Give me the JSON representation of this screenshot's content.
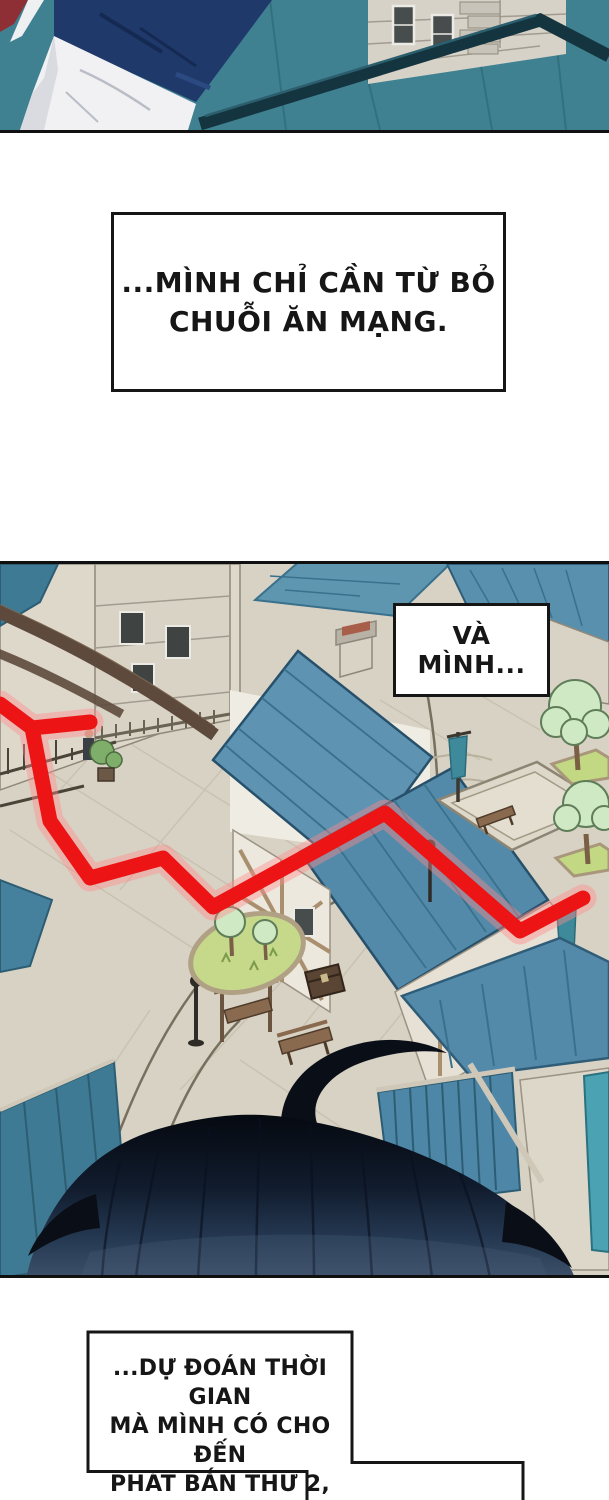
{
  "page": {
    "kind": "webtoon-comic-page",
    "background": "#ffffff"
  },
  "speech": {
    "box1": {
      "lines": [
        "...MÌNH CHỈ CẦN TỪ BỎ",
        "CHUỖI ĂN MẠNG."
      ]
    },
    "box_va": {
      "lines": [
        "VÀ MÌNH..."
      ]
    },
    "box2": {
      "lines": [
        "...DỰ ĐOÁN THỜI GIAN",
        "MÀ MÌNH CÓ CHO ĐẾN",
        "PHÁT BẮN THỨ 2,"
      ]
    }
  },
  "panels": [
    {
      "id": "panel-top",
      "alt": "close-up: navy jacket and white trousers of a character standing on a teal rooftop beside a stone building"
    },
    {
      "id": "panel-town",
      "alt": "isometric medieval town plaza with teal roofs; a thick red route line zigzags across the streets; dark back-of-head silhouette rises from the bottom"
    }
  ],
  "colors": {
    "red_path": "#ec1414",
    "red_glow": "#ff8a8a",
    "panel1_teal": "#3f8191",
    "jacket_navy": "#20396b",
    "pants_white": "#f1f1f3",
    "ground_beige": "#d8d2c4",
    "roof_mid": "#5e93b2",
    "roof_deep": "#3f7a94",
    "roof_bright_wall": "#4aa2b2",
    "awning_stripe_blue": "#4e86ac",
    "tree_green": "#cfe9c4",
    "grass_green": "#c6d98a",
    "head_dark": "#0a0f17",
    "outline_black": "#161616"
  }
}
